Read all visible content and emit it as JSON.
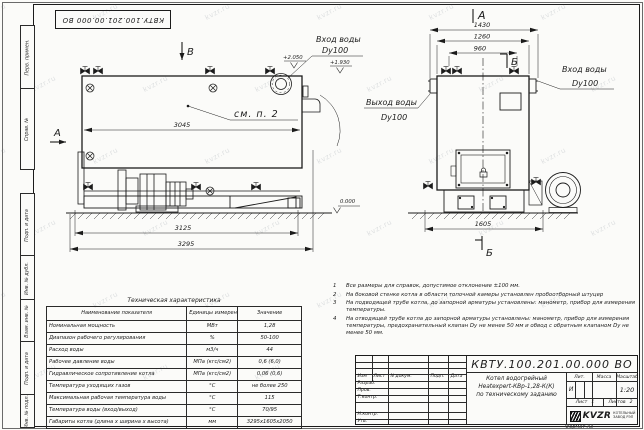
{
  "watermark": "kvzr.ru",
  "frame": {
    "top_stamp": "КВТУ.100.201.00.000 ВО",
    "sidebar_labels": [
      "Перв. примен.",
      "Справ. №",
      "Подп. и дата",
      "Инв. № дубл.",
      "Взам. инв. №",
      "Подп. и дата",
      "Инв. № подл."
    ]
  },
  "views": {
    "side": {
      "marker_b": "В",
      "marker_a": "А",
      "callout": "см. п. 2",
      "dim_3045": "3045",
      "dim_3125": "3125",
      "dim_3295": "3295",
      "elev_2050": "+2.050",
      "elev_1930": "+1.930",
      "elev_0": "0.000",
      "inlet_line1": "Вход воды",
      "inlet_line2": "Dy100"
    },
    "front": {
      "marker_a": "А",
      "marker_b_top": "Б",
      "marker_b_bottom": "Б",
      "dim_1430": "1430",
      "dim_1260": "1260",
      "dim_960": "960",
      "dim_1605": "1605",
      "outlet_line1": "Выход воды",
      "outlet_line2": "Dy100",
      "inlet_line1": "Вход воды",
      "inlet_line2": "Dy100"
    }
  },
  "tech_table": {
    "title": "Техническая характеристика",
    "headers": [
      "Наименование показателя",
      "Единицы измерения",
      "Значение"
    ],
    "rows": [
      [
        "Номинальная мощность",
        "МВт",
        "1,28"
      ],
      [
        "Диапазон рабочего регулирования",
        "%",
        "50-100"
      ],
      [
        "Расход воды",
        "м3/ч",
        "44"
      ],
      [
        "Рабочее давление воды",
        "МПа (кгс/см2)",
        "0,6 (6,0)"
      ],
      [
        "Гидравлическое сопротивление котла",
        "МПа (кгс/см2)",
        "0,06 (0,6)"
      ],
      [
        "Температура уходящих газов",
        "°С",
        "не более 250"
      ],
      [
        "Максимальная рабочая температура воды",
        "°С",
        "115"
      ],
      [
        "Температура воды (вход/выход)",
        "°С",
        "70/95"
      ],
      [
        "Габариты котла (длина х ширина х высота)",
        "мм",
        "3295х1605х2050"
      ]
    ]
  },
  "notes": {
    "items": [
      {
        "num": "1",
        "text": "Все размеры для справок, допустимое отклонение ±100 мм."
      },
      {
        "num": "2",
        "text": "На боковой стенке котла в области топочной камеры установлен пробоотборный штуцер"
      },
      {
        "num": "3",
        "text": "На подводящей трубе котла, до запорной арматуры установлены: манометр, прибор для измерения температуры."
      },
      {
        "num": "4",
        "text": "На отводящей трубе котла до запорной арматуры установлены: манометр, прибор для измерения температуры, предохранительный клапан Dy не менее 50 мм и обвод с обратным клапаном Dy не менее 50 мм."
      }
    ]
  },
  "title_block": {
    "doc_number": "КВТУ.100.201.00.000 ВО",
    "header_cols": [
      "Изм",
      "Лист",
      "N докум.",
      "Подп.",
      "Дата"
    ],
    "row_labels": [
      "Разраб.",
      "Пров.",
      "Т.контр.",
      "Н.контр.",
      "Утв."
    ],
    "doc_name_line1": "Котел водогрейный",
    "doc_name_line2": "Heatexpert-КВр-1,28-К(К)",
    "doc_name_line3": "по техническому заданию",
    "lit_header": "Лит.",
    "mass_header": "Масса",
    "scale_header": "Масштаб",
    "lit_value": "И",
    "scale_value": "1:20",
    "sheet_label": "Лист",
    "sheet_value": "1",
    "sheets_label": "Листов",
    "sheets_value": "2",
    "logo_word": "KVZR",
    "logo_sub1": "КОТЕЛЬНЫЙ",
    "logo_sub2": "ЗАВОД РЭП",
    "format_label": "Формат",
    "format_value": "А3"
  }
}
